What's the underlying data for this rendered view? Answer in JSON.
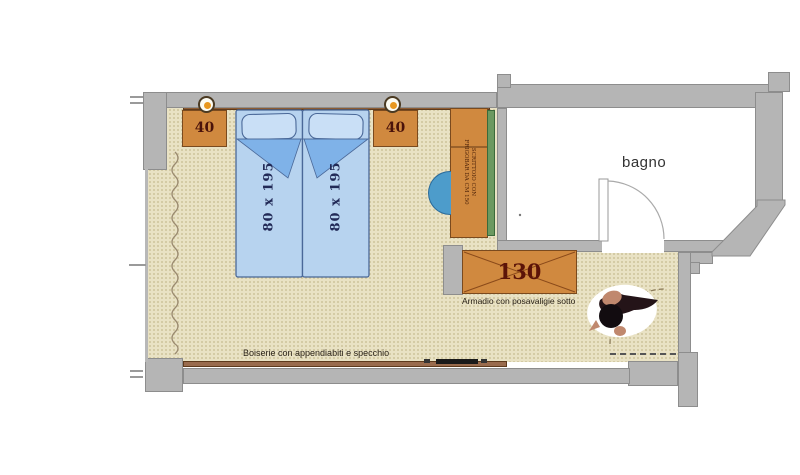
{
  "floor_plan": {
    "rooms": {
      "bathroom_label": "bagno"
    },
    "beds": {
      "left_dimension": "80 x 195",
      "right_dimension": "80 x 195"
    },
    "nightstands": {
      "left_width": "40",
      "right_width": "40"
    },
    "wardrobe": {
      "width": "130",
      "caption": "Armadio con posavaligie sotto"
    },
    "desk": {
      "label_line1": "SCRITTOIO CON",
      "label_line2": "FRIGOBAR DA CM 150"
    },
    "boiserie": {
      "caption": "Boiserie con appendiabiti e specchio"
    },
    "colors": {
      "wall": "#b5b5b5",
      "floor": "#e9e2c4",
      "furniture": "#d0893f",
      "bed": "#b7d3ef",
      "bed_fold": "#7fb2e8",
      "bed_outline": "#4a6898",
      "dimension_text": "#5c1a0e",
      "bed_text": "#222a57",
      "curtain": "#9b8b70",
      "chair": "#4d9ccb",
      "desk_side_panel": "#6b9960",
      "headboard": "#8d5c33"
    }
  }
}
